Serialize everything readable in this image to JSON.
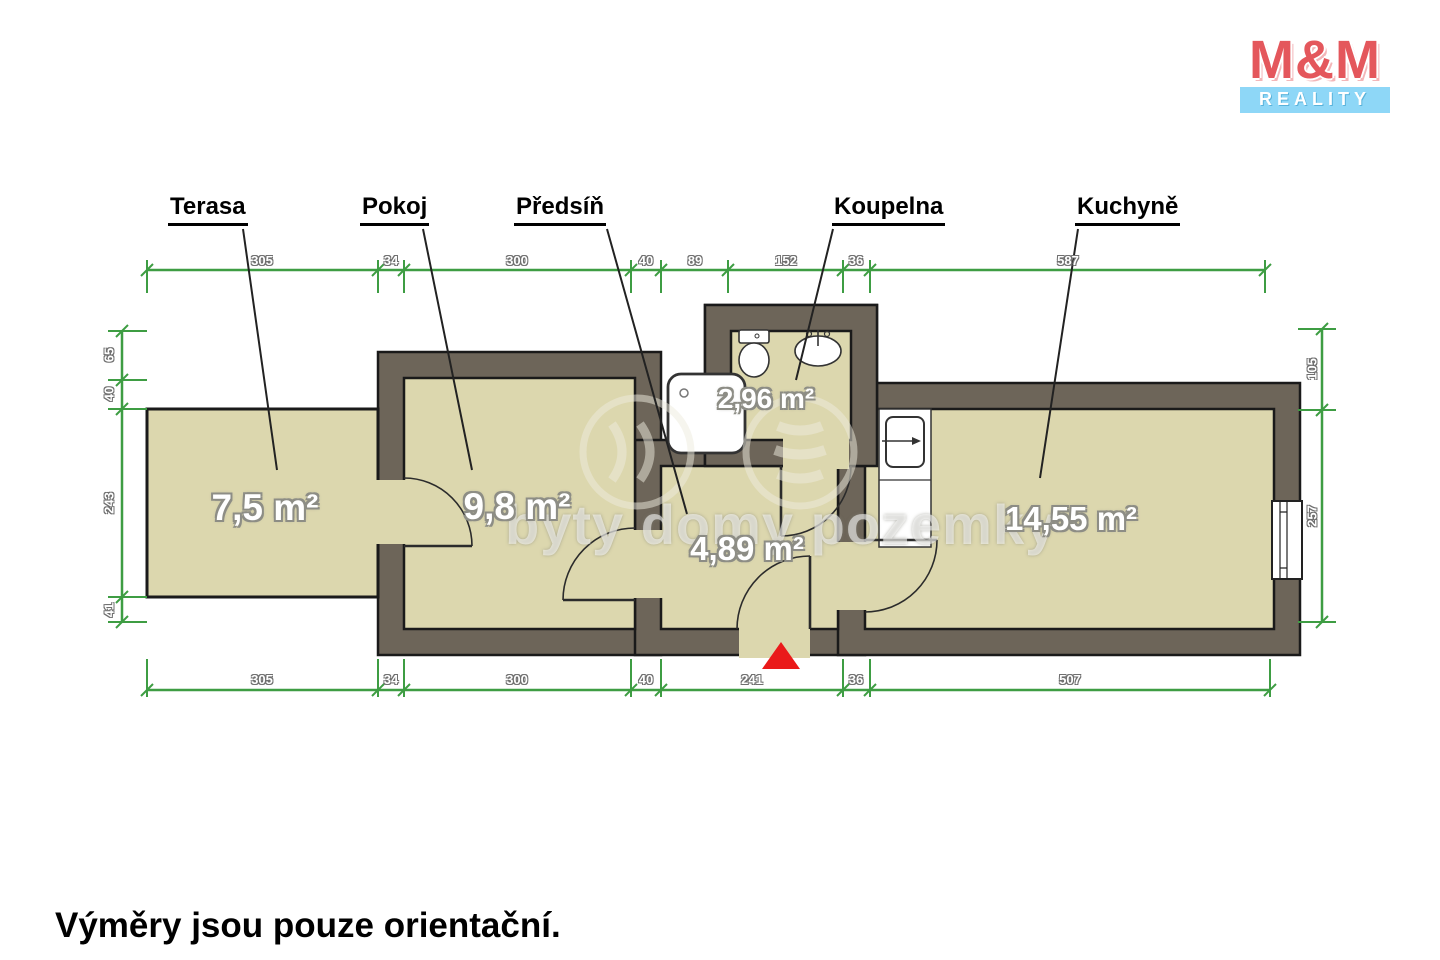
{
  "logo": {
    "brand": "M&M",
    "tagline": "REALITY"
  },
  "rooms": {
    "terasa": {
      "label": "Terasa",
      "area": "7,5 m²"
    },
    "pokoj": {
      "label": "Pokoj",
      "area": "9,8 m²"
    },
    "predsin": {
      "label": "Předsíň",
      "area": "4,89 m²"
    },
    "koupelna": {
      "label": "Koupelna",
      "area": "2,96 m²"
    },
    "kuchyne": {
      "label": "Kuchyně",
      "area": "14,55 m²"
    }
  },
  "dimensions_cm": {
    "top": [
      "305",
      "34",
      "300",
      "40",
      "89",
      "152",
      "36",
      "587"
    ],
    "bottom": [
      "305",
      "34",
      "300",
      "40",
      "241",
      "36",
      "507"
    ],
    "left": [
      "65",
      "40",
      "243",
      "41"
    ],
    "right": [
      "105",
      "257"
    ]
  },
  "watermark": {
    "text": "byty domy pozemky"
  },
  "footer": {
    "note": "Výměry jsou pouze orientační."
  },
  "colors": {
    "wall": "#6d6559",
    "floor": "#dcd7ae",
    "dimension_green": "#3e9d43",
    "entrance_marker_red": "#ea1a1a",
    "logo_red": "#e4575c",
    "logo_blue": "#8ed7f7"
  }
}
